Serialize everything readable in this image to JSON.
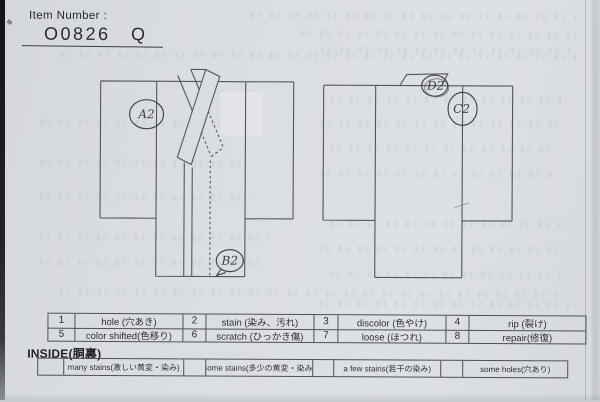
{
  "item_number": {
    "label": "Item Number :",
    "value": "O0826 Q"
  },
  "markers": {
    "front": [
      "A2",
      "B2"
    ],
    "back": [
      "D2",
      "C2"
    ]
  },
  "defect_table": {
    "rows": [
      [
        {
          "num": "1",
          "label": "hole (穴あき)"
        },
        {
          "num": "2",
          "label": "stain (染み、汚れ)"
        },
        {
          "num": "3",
          "label": "discolor (色やけ)"
        },
        {
          "num": "4",
          "label": "rip (裂け)"
        }
      ],
      [
        {
          "num": "5",
          "label": "color shifted(色移り)"
        },
        {
          "num": "6",
          "label": "scratch (ひっかき傷)"
        },
        {
          "num": "7",
          "label": "loose (ほつれ)"
        },
        {
          "num": "8",
          "label": "repair(修復)"
        }
      ]
    ]
  },
  "inside_section": {
    "title": "INSIDE(胴裏)",
    "options": [
      "many stains(激しい黄変・染み)",
      "some stains(多少の黄変・染み)",
      "a few stains(若干の染み)",
      "some holes(穴あり)"
    ]
  }
}
